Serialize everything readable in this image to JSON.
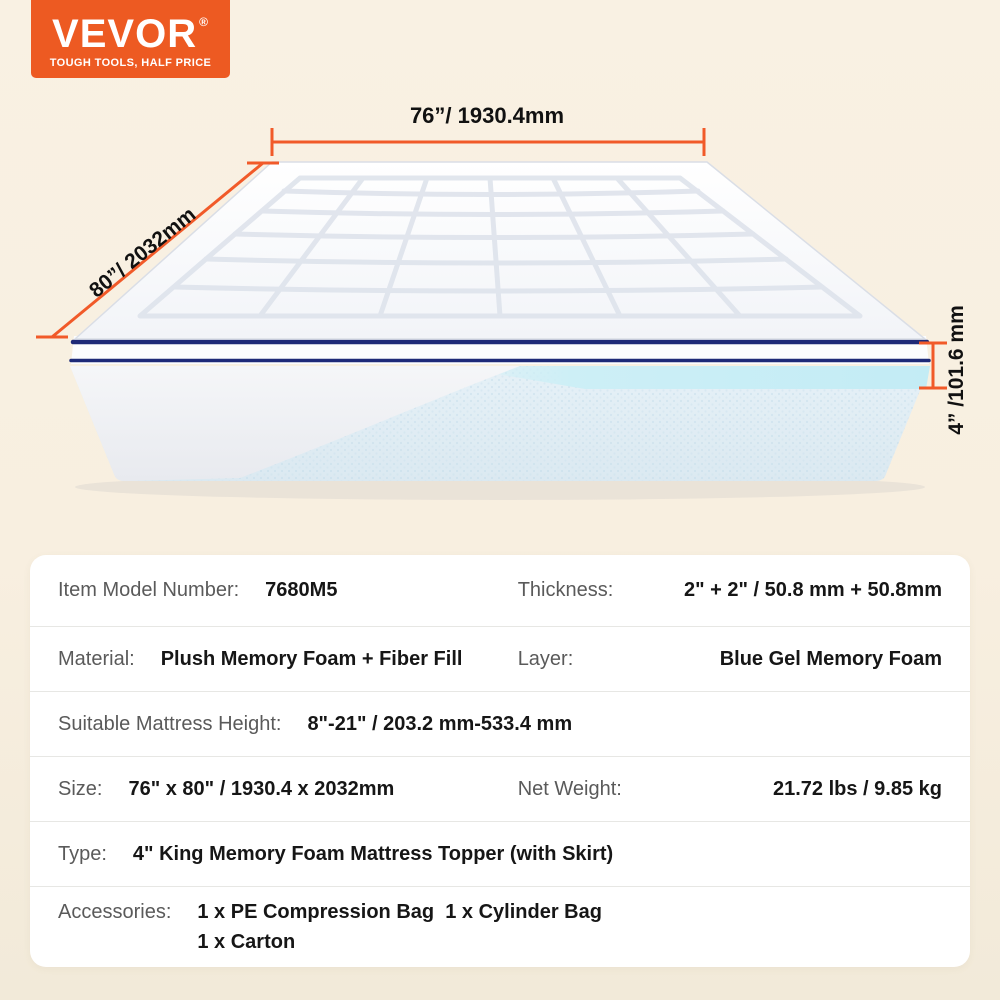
{
  "brand": {
    "logo_text": "VEVOR",
    "registered_mark": "®",
    "tagline": "TOUGH TOOLS, HALF PRICE",
    "badge_color": "#ed5a22"
  },
  "illustration": {
    "dimension_labels": {
      "width": "76”/ 1930.4mm",
      "depth": "80”/ 2032mm",
      "height": "4” /101.6 mm"
    },
    "accent_color": "#f15a29",
    "piping_color": "#1e2a78",
    "gel_layer_color": "#cdeff6"
  },
  "spec_table": {
    "rows": [
      {
        "pairs": [
          {
            "label": "Item Model Number:",
            "value": "7680M5"
          },
          {
            "label": "Thickness:",
            "value": "2\" + 2\" / 50.8 mm + 50.8mm"
          }
        ]
      },
      {
        "pairs": [
          {
            "label": "Material:",
            "value": "Plush Memory Foam + Fiber Fill"
          },
          {
            "label": "Layer:",
            "value": "Blue Gel Memory Foam"
          }
        ]
      },
      {
        "pairs": [
          {
            "label": "Suitable Mattress Height:",
            "value": "8\"-21\" / 203.2 mm-533.4 mm"
          }
        ]
      },
      {
        "pairs": [
          {
            "label": "Size:",
            "value": "76\" x 80\" / 1930.4 x 2032mm"
          },
          {
            "label": "Net Weight:",
            "value": "21.72 lbs / 9.85 kg"
          }
        ]
      },
      {
        "pairs": [
          {
            "label": "Type:",
            "value": "4\" King Memory Foam Mattress Topper (with Skirt)"
          }
        ]
      },
      {
        "pairs": [
          {
            "label": "Accessories:",
            "value": "1 x PE Compression Bag  1 x Cylinder Bag\n1 x Carton"
          }
        ]
      }
    ]
  }
}
